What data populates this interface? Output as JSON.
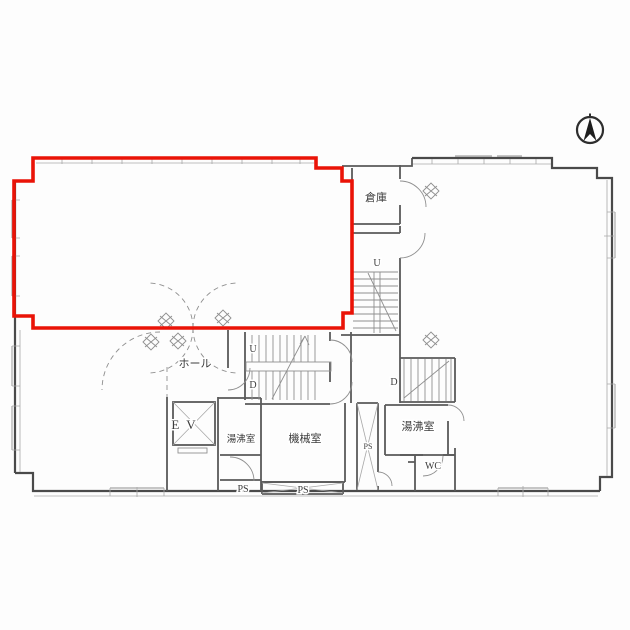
{
  "plan": {
    "highlight_color": "#ea1307",
    "rooms": {
      "storage": "倉庫",
      "hall": "ホール",
      "machine_room": "機械室",
      "kitchenette_center": "湯沸室",
      "kitchenette_right": "湯沸室",
      "toilet": "WC",
      "elevator": "EV"
    },
    "shafts": {
      "ps_left": "PS",
      "ps_center": "PS",
      "ps_right": "PS"
    },
    "stairs": {
      "center_up": "U",
      "center_down": "D",
      "right_up": "U",
      "right_down": "D"
    },
    "compass": "north"
  }
}
